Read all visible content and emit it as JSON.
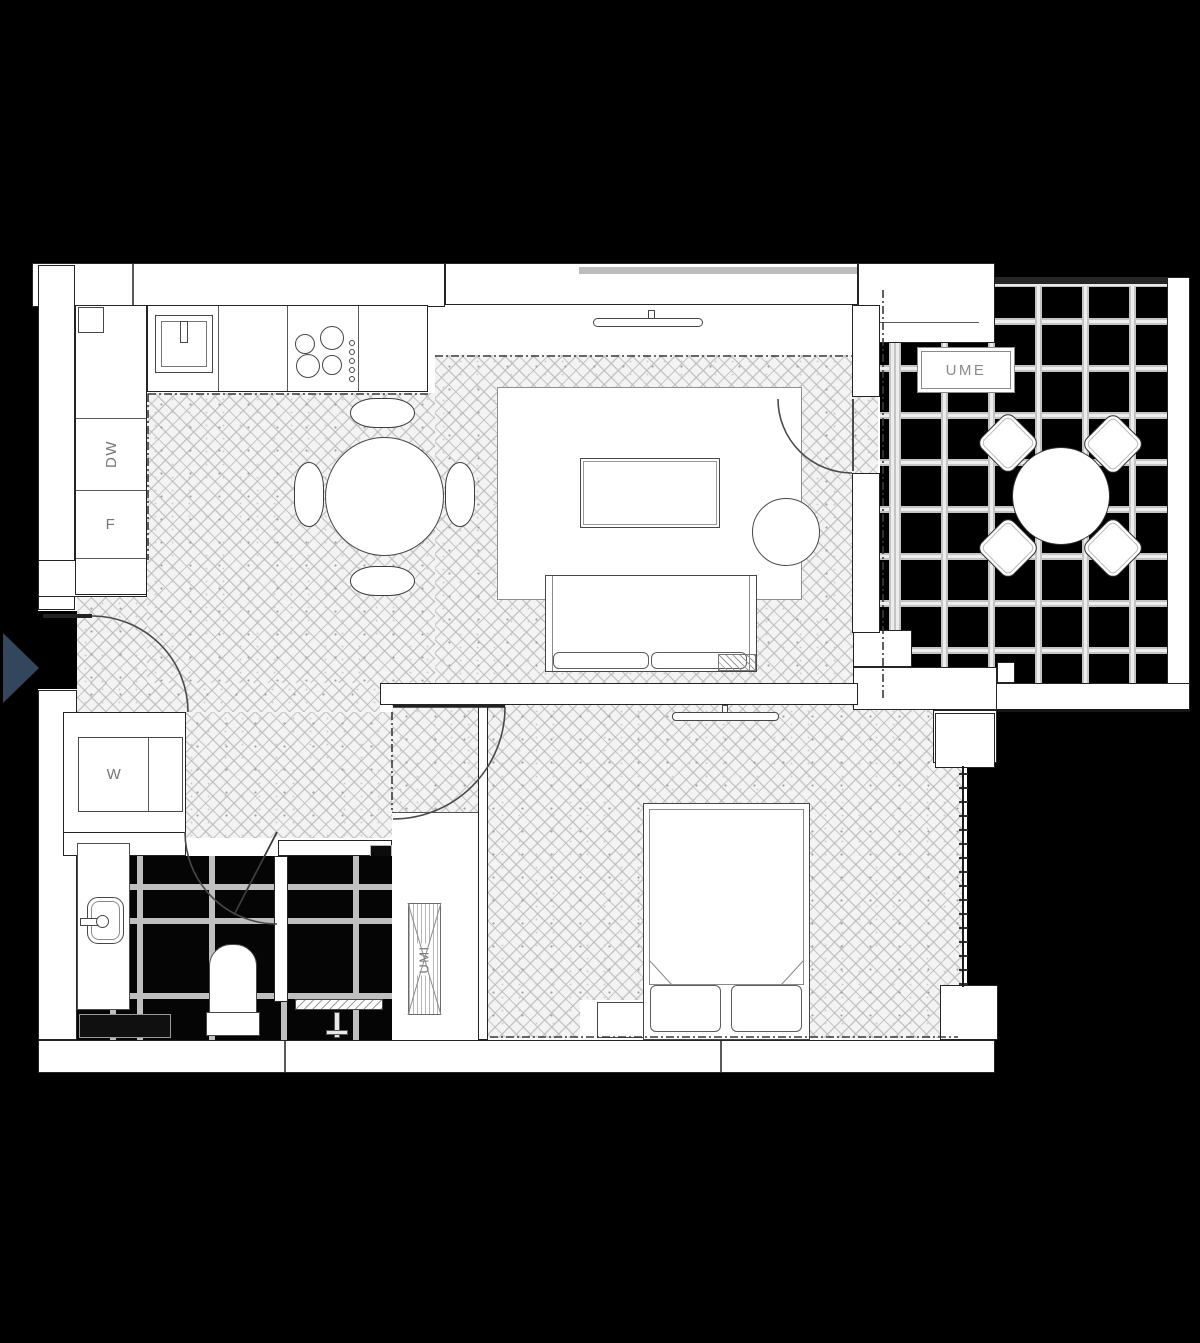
{
  "plan_labels": {
    "dishwasher": "DW",
    "fridge": "F",
    "washing_machine": "W",
    "balcony_cabinet": "UME",
    "wardrobe": "UMI"
  },
  "colors": {
    "background": "#000000",
    "walls": "#ffffff",
    "outline": "#2a2a2a",
    "wood_floor": "#f3f3f3",
    "tile_grout": "#c9c9c9",
    "label_text": "#767676",
    "entry_arrow": "#33475c"
  },
  "rooms": [
    "kitchen-dining",
    "living-room",
    "hallway",
    "bathroom",
    "bedroom",
    "balcony"
  ],
  "furniture": [
    "kitchen-counter",
    "sink",
    "cooktop",
    "dining-table",
    "dining-chairs",
    "tv",
    "rug",
    "coffee-table",
    "side-table",
    "sofa",
    "washing-machine",
    "vanity",
    "toilet",
    "shower-drain",
    "wardrobe",
    "bed",
    "pillows",
    "bedside-table",
    "balcony-table",
    "balcony-chairs"
  ]
}
